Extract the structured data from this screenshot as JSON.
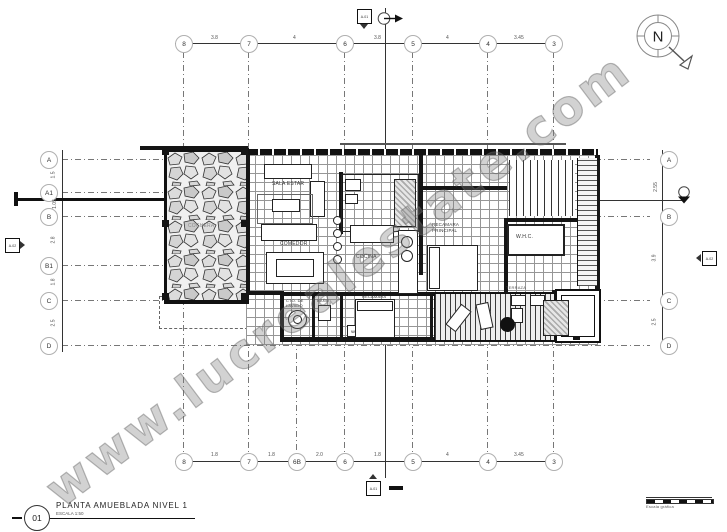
{
  "drawing": {
    "number": "01",
    "title": "PLANTA AMUEBLADA NIVEL 1",
    "scale": "ESCALA 1:50",
    "watermark": "www.lucrealestate.com",
    "north": "N",
    "graphic_scale": "Escala gráfica"
  },
  "grid": {
    "top": [
      "8",
      "7",
      "6",
      "5",
      "4",
      "3"
    ],
    "bottom": [
      "8",
      "7",
      "6B",
      "6",
      "5",
      "4",
      "3"
    ],
    "left": [
      "A",
      "A1",
      "B",
      "B1",
      "C",
      "D"
    ],
    "right": [
      "A",
      "B",
      "C",
      "D"
    ],
    "dims_top": [
      "3.8",
      "4",
      "3.8",
      "4",
      "3.45"
    ],
    "dims_bottom": [
      "1.8",
      "1.8",
      "2.0",
      "1.8",
      "4",
      "3.45"
    ],
    "dims_left": [
      "1.5",
      "1.05",
      "2.8",
      "1.8",
      "2.5"
    ],
    "dims_right": [
      "2.55",
      "3.9",
      "2.5"
    ]
  },
  "rooms": {
    "cochera": "COCHERA",
    "sala": "SALA ESTAR",
    "comedor": "COMEDOR",
    "cocina": "COCINA",
    "recamara_principal_1": "RECAMARA",
    "recamara_principal_2": "PRINCIPAL",
    "whc": "W.H.C.",
    "lavado_1": "CTO. DE",
    "lavado_2": "LAVADO",
    "bano": "BAÑO",
    "recamara": "RECAMARA",
    "terraza": "TERRAZA",
    "wc": "W"
  },
  "markers": {
    "section_vertical": "A-01",
    "section_horizontal": "A-02"
  },
  "colors": {
    "line": "#151515",
    "grid_line": "#777777",
    "watermark": "#7a7a7a"
  }
}
